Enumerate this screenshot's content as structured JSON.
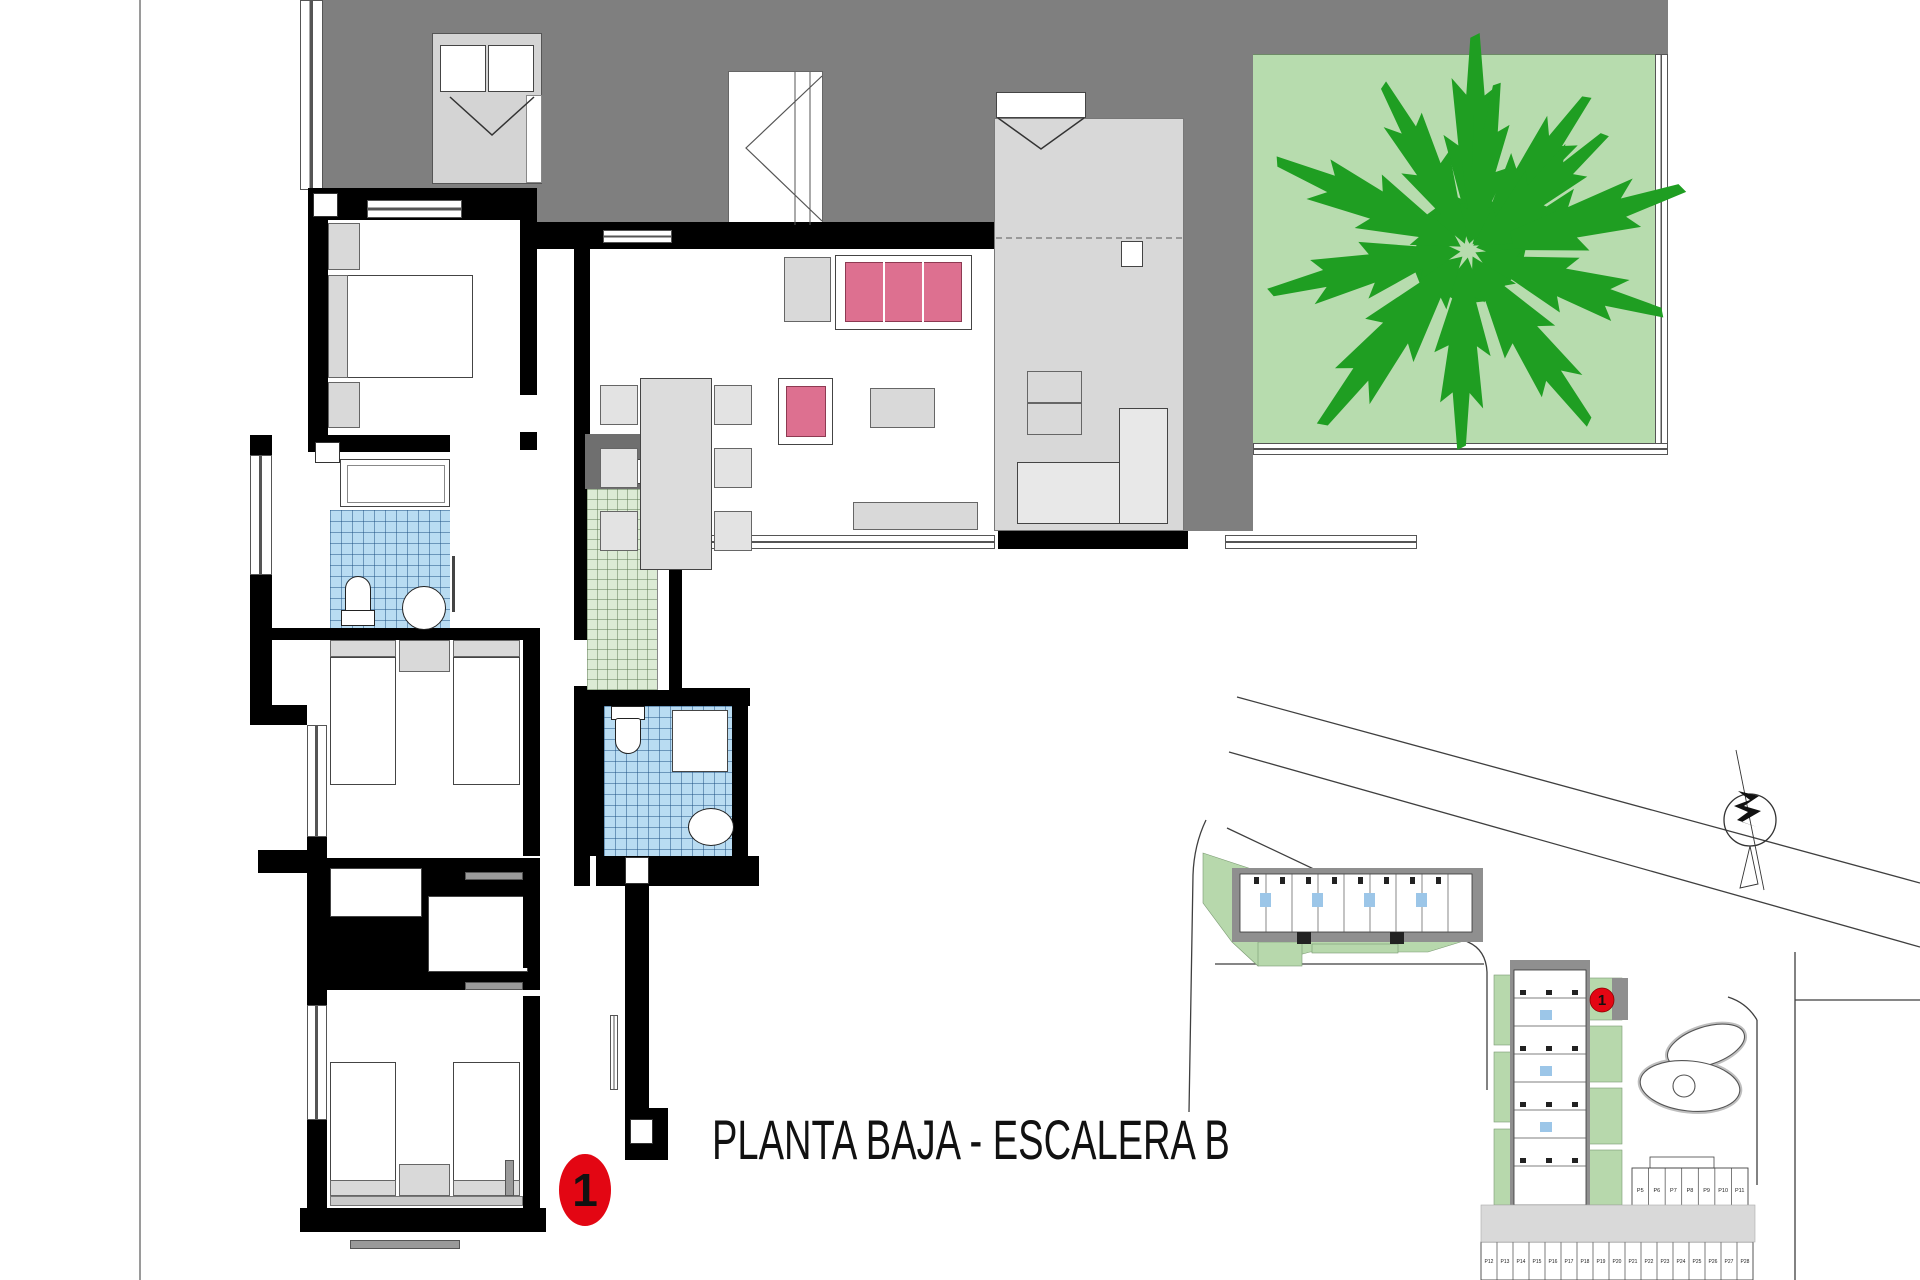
{
  "title": "PLANTA BAJA - ESCALERA B",
  "unit_marker": "1",
  "site_plan": {
    "marker": "1",
    "parking_row_1": [
      "P5",
      "P6",
      "P7",
      "P8",
      "P9",
      "P10",
      "P11"
    ],
    "parking_row_2": [
      "P12",
      "P13",
      "P14",
      "P15",
      "P16",
      "P17",
      "P18",
      "P19",
      "P20",
      "P21",
      "P22",
      "P23",
      "P24",
      "P25",
      "P26",
      "P27",
      "P28"
    ]
  },
  "colors": {
    "terrace_gray": "#7f7f7f",
    "porch_gray": "#d8d8d8",
    "garden_green": "#b7dcae",
    "tree_green": "#1f9e22",
    "tile_blue": "#b9dcf2",
    "tile_green": "#dcebd5",
    "sofa_pink": "#dd7090",
    "marker_red": "#e30613",
    "wall_black": "#000000",
    "site_green": "#b7d8ac",
    "site_path_gray": "#8f8f8f"
  }
}
